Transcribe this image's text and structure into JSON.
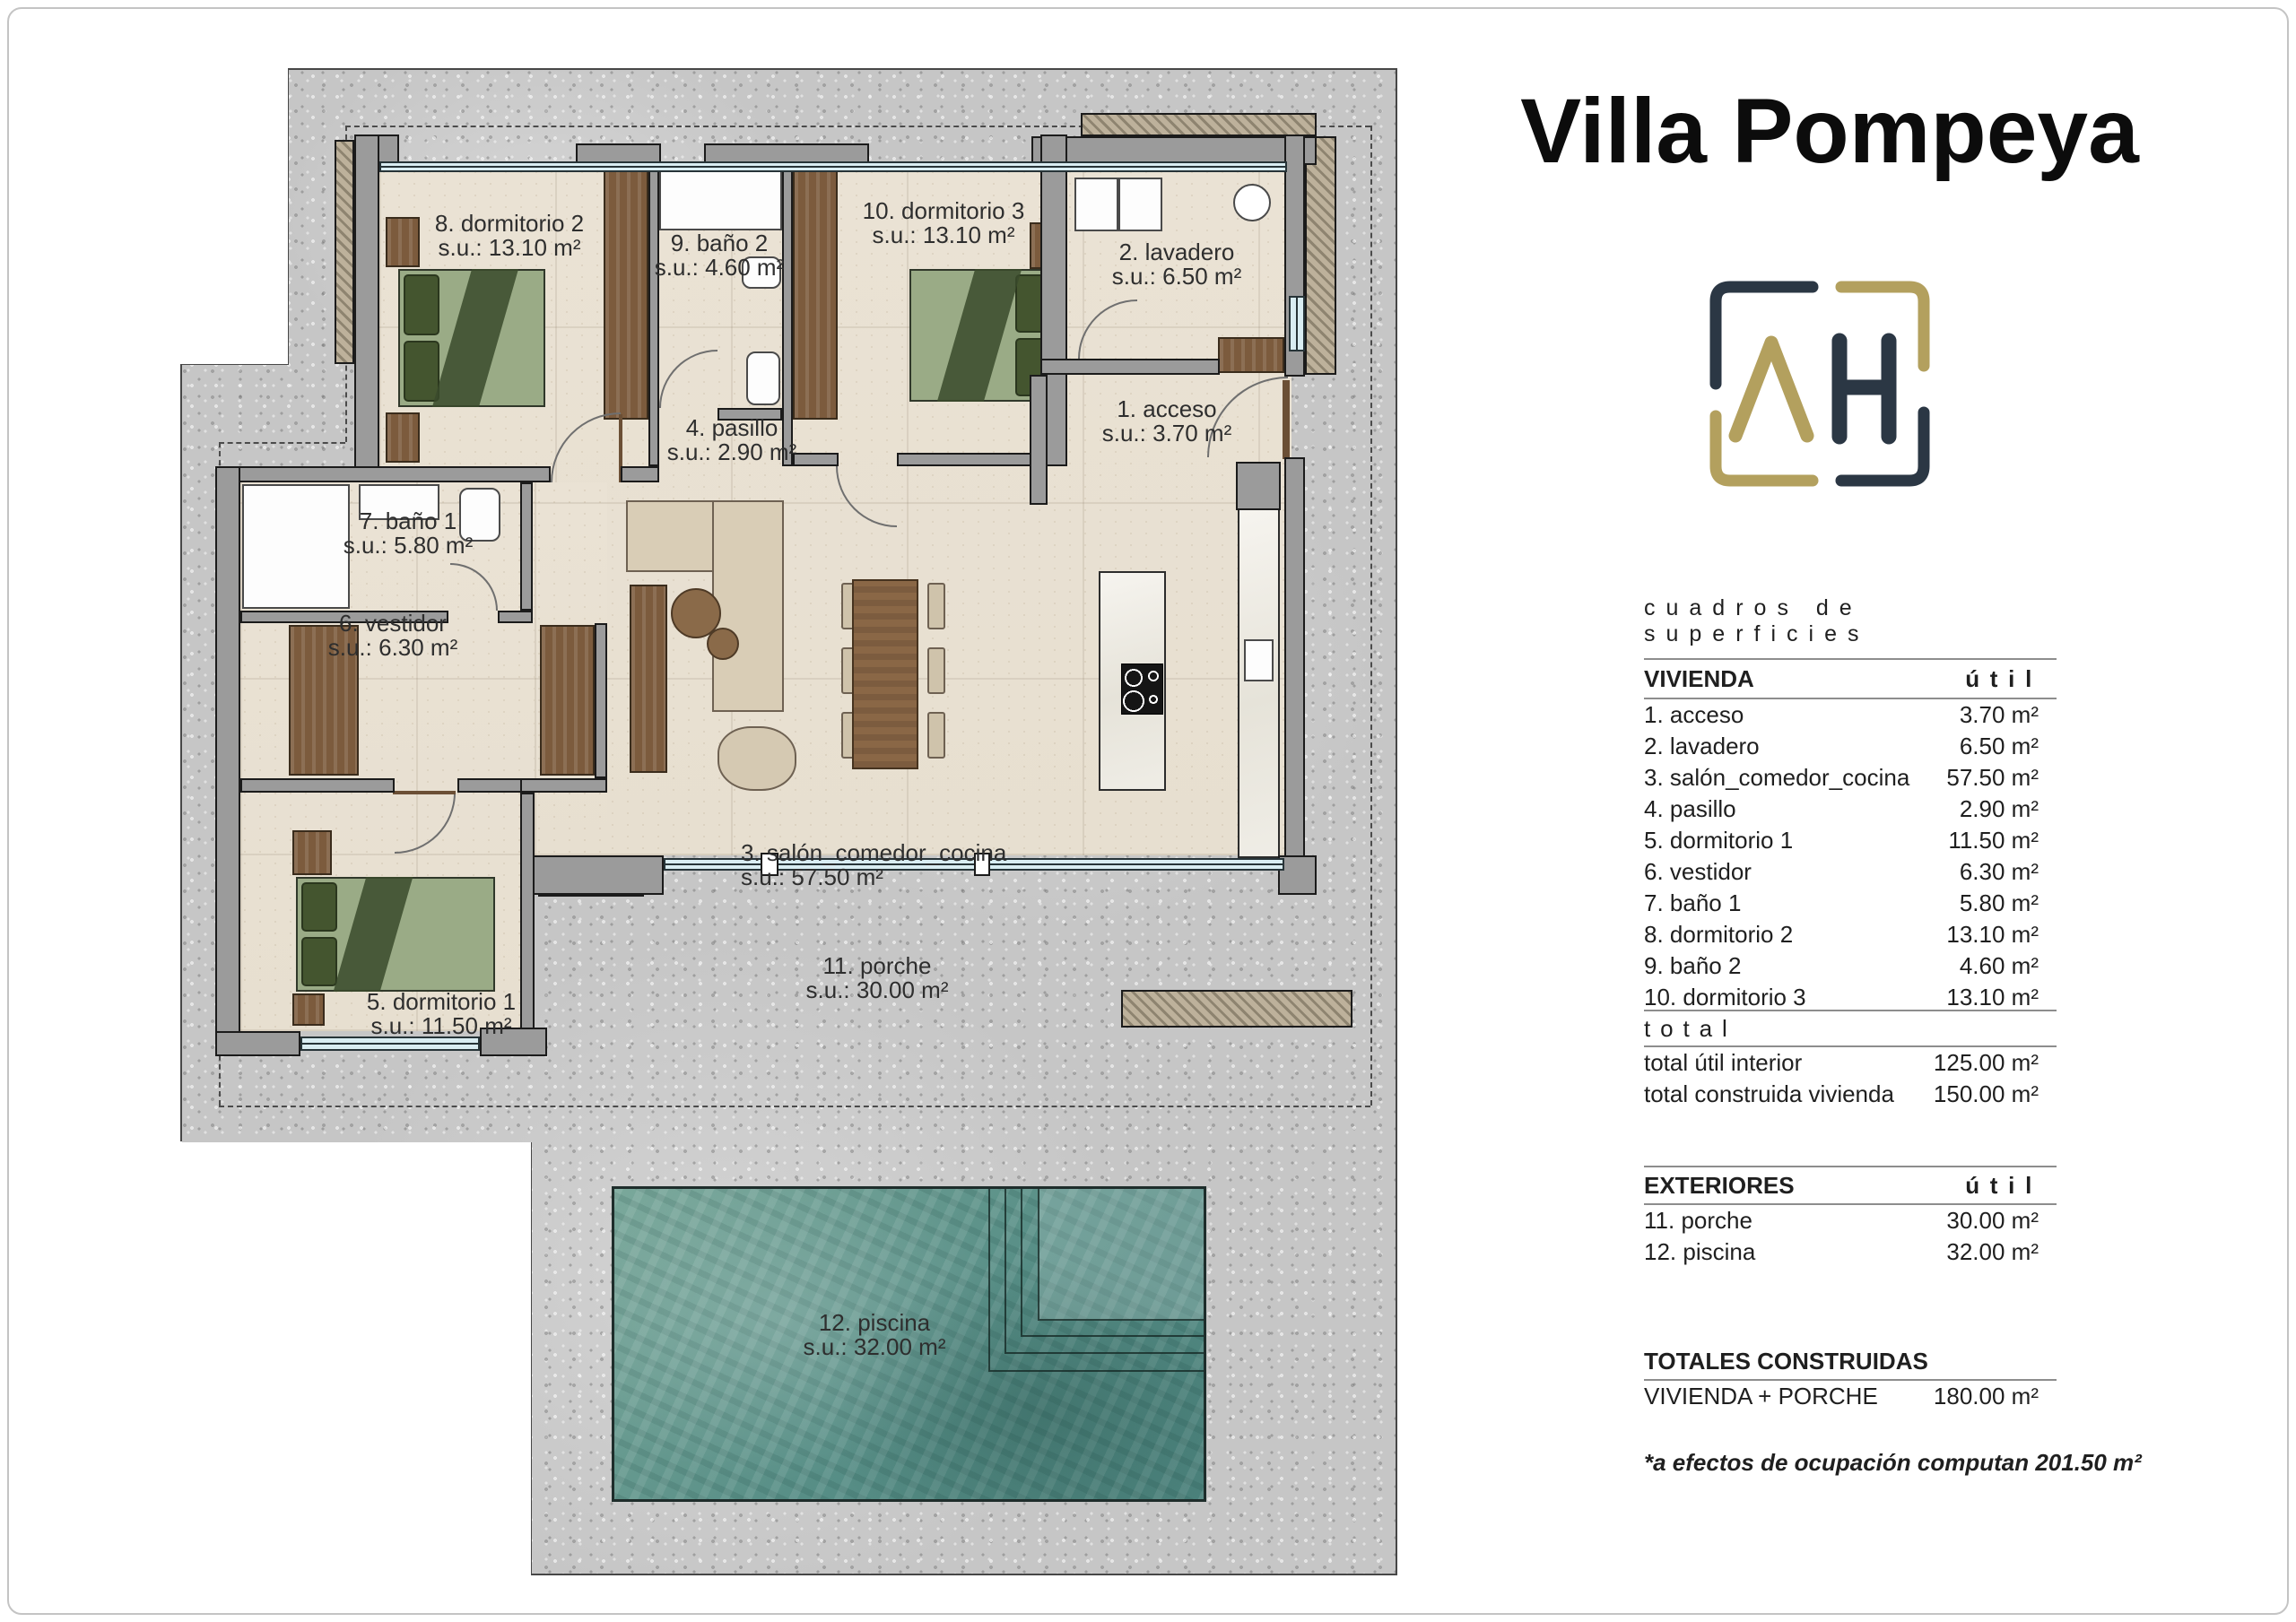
{
  "title": "Villa Pompeya",
  "logo": {
    "letter_a": "A",
    "letter_h": "H",
    "navy": "#2b3744",
    "gold": "#b3a05e"
  },
  "surfaces": {
    "section_title": "cuadros de superficies",
    "unit_header": "útil",
    "vivienda": {
      "header": "VIVIENDA",
      "rows": [
        {
          "label": "1. acceso",
          "value": "3.70 m²"
        },
        {
          "label": "2. lavadero",
          "value": "6.50 m²"
        },
        {
          "label": "3. salón_comedor_cocina",
          "value": "57.50 m²"
        },
        {
          "label": "4. pasillo",
          "value": "2.90 m²"
        },
        {
          "label": "5. dormitorio 1",
          "value": "11.50 m²"
        },
        {
          "label": "6. vestidor",
          "value": "6.30 m²"
        },
        {
          "label": "7. baño 1",
          "value": "5.80 m²"
        },
        {
          "label": "8. dormitorio 2",
          "value": "13.10 m²"
        },
        {
          "label": "9. baño 2",
          "value": "4.60 m²"
        },
        {
          "label": "10. dormitorio 3",
          "value": "13.10 m²"
        }
      ]
    },
    "total": {
      "header": "total",
      "rows": [
        {
          "label": "total útil interior",
          "value": "125.00 m²"
        },
        {
          "label": "total construida vivienda",
          "value": "150.00 m²"
        }
      ]
    },
    "exteriores": {
      "header": "EXTERIORES",
      "rows": [
        {
          "label": "11. porche",
          "value": "30.00 m²"
        },
        {
          "label": "12. piscina",
          "value": "32.00 m²"
        }
      ]
    },
    "totales": {
      "header": "TOTALES CONSTRUIDAS",
      "rows": [
        {
          "label": "VIVIENDA + PORCHE",
          "value": "180.00 m²"
        }
      ]
    },
    "footnote": "*a efectos de ocupación computan 201.50 m²"
  },
  "plan": {
    "labels": [
      {
        "id": "dormitorio2",
        "name": "8. dormitorio 2",
        "su": "s.u.: 13.10 m²"
      },
      {
        "id": "bano2",
        "name": "9. baño 2",
        "su": "s.u.: 4.60 m²"
      },
      {
        "id": "dormitorio3",
        "name": "10. dormitorio 3",
        "su": "s.u.: 13.10 m²"
      },
      {
        "id": "lavadero",
        "name": "2. lavadero",
        "su": "s.u.: 6.50 m²"
      },
      {
        "id": "acceso",
        "name": "1. acceso",
        "su": "s.u.: 3.70 m²"
      },
      {
        "id": "pasillo",
        "name": "4. pasillo",
        "su": "s.u.: 2.90 m²"
      },
      {
        "id": "bano1",
        "name": "7. baño 1",
        "su": "s.u.: 5.80 m²"
      },
      {
        "id": "vestidor",
        "name": "6. vestidor",
        "su": "s.u.: 6.30 m²"
      },
      {
        "id": "salon",
        "name": "3. salón_comedor_cocina",
        "su": "s.u.: 57.50 m²"
      },
      {
        "id": "dormitorio1",
        "name": "5. dormitorio 1",
        "su": "s.u.: 11.50 m²"
      },
      {
        "id": "porche",
        "name": "11. porche",
        "su": "s.u.: 30.00 m²"
      },
      {
        "id": "piscina",
        "name": "12. piscina",
        "su": "s.u.: 32.00 m²"
      }
    ]
  }
}
